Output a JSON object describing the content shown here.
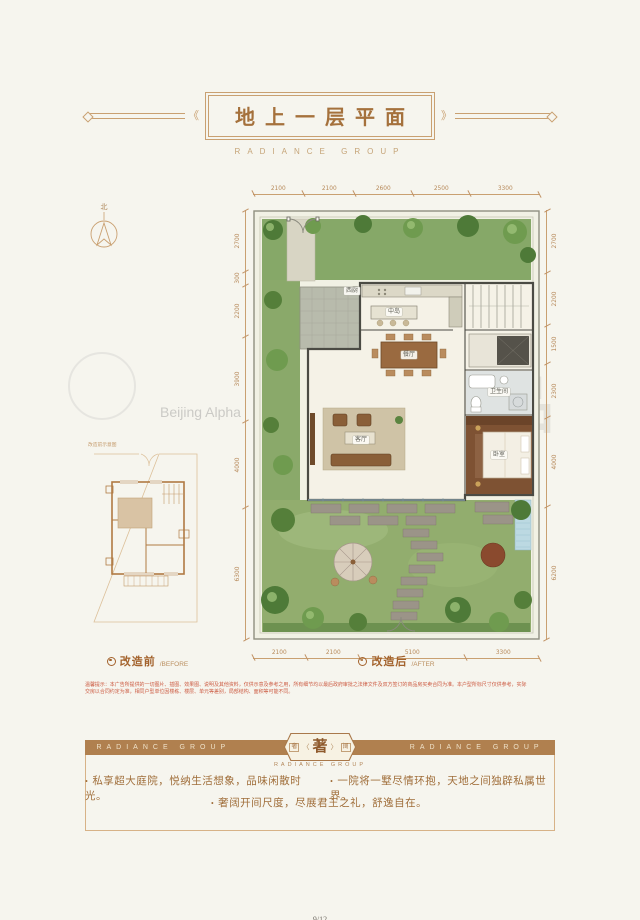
{
  "header": {
    "title": "地上一层平面",
    "subtitle": "RADIANCE GROUP"
  },
  "compass": {
    "north": "北"
  },
  "plan": {
    "dims": {
      "top": [
        "2100",
        "2100",
        "2600",
        "2500",
        "3300"
      ],
      "bottom": [
        "2100",
        "2100",
        "5100",
        "3300"
      ],
      "left": [
        "2700",
        "300",
        "2200",
        "3900",
        "4000",
        "6300"
      ],
      "right": [
        "2700",
        "2200",
        "1500",
        "2300",
        "4000",
        "6200"
      ]
    },
    "rooms": {
      "west_kitchen": "西厨",
      "island": "中岛",
      "dining": "餐厅",
      "living": "客厅",
      "bathroom": "卫生间",
      "bedroom": "卧室"
    }
  },
  "inset": {
    "caption": "改造前示意图"
  },
  "legends": {
    "before": {
      "label": "改造前",
      "sub": "/BEFORE"
    },
    "after": {
      "label": "改造后",
      "sub": "/AFTER"
    }
  },
  "disclaimer": {
    "line1": "温馨提示：本广告所提供的一切图片、插图、效果图、说明及其他资料，仅供示意及参考之用，所有细节均以最后政府审批之法律文件及双方签订的商品房买卖合同为准。本户型所标尺寸仅供参考，实际",
    "line2": "交房以合同约定为准，相同户型单位因楼栋、楼层、单元等差别，局部结构、面积等可能不同。"
  },
  "banner": {
    "left_text": "RADIANCE GROUP",
    "right_text": "RADIANCE GROUP",
    "emblem": {
      "left": "奢",
      "center": "著",
      "right": "阔",
      "open_mark": "〈",
      "close_mark": "〉"
    },
    "sub": "RADIANCE GROUP"
  },
  "features": {
    "items": [
      "私享超大庭院，悦纳生活想象，品味闲散时光。",
      "一院将一墅尽情环抱，天地之间独辟私属世界。",
      "奢阔开间尺度，尽展君王之礼，舒逸自在。"
    ]
  },
  "watermark": {
    "big": "成品",
    "small": "Beijing Alpha"
  },
  "footer": {
    "page": "9/12"
  },
  "colors": {
    "accent": "#a5713c",
    "banner": "#b0804f",
    "dim": "#b78a5b",
    "disclaimer": "#cc5a41",
    "paper": "#f6f5ee"
  }
}
